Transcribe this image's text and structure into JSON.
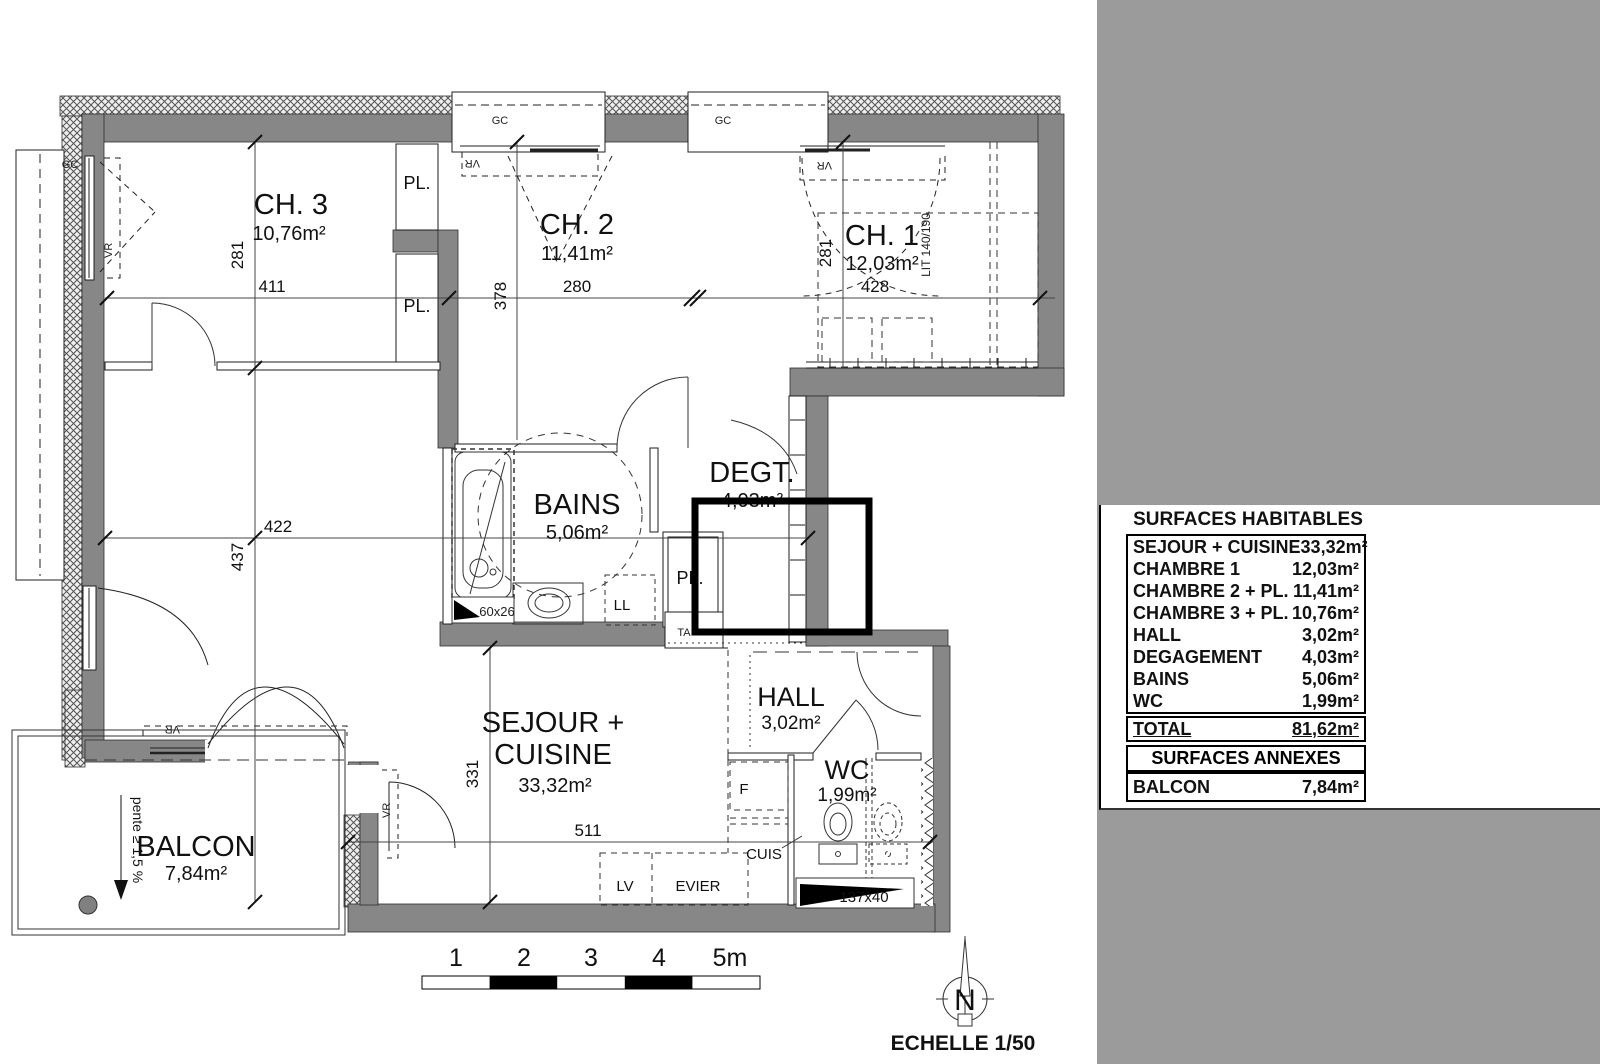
{
  "plan": {
    "rooms": {
      "ch3": {
        "name": "CH. 3",
        "area": "10,76m²"
      },
      "ch2": {
        "name": "CH. 2",
        "area": "11,41m²"
      },
      "ch1": {
        "name": "CH. 1",
        "area": "12,03m²"
      },
      "bains": {
        "name": "BAINS",
        "area": "5,06m²"
      },
      "degt": {
        "name": "DEGT.",
        "area": "4,03m²"
      },
      "hall": {
        "name": "HALL",
        "area": "3,02m²"
      },
      "wc": {
        "name": "WC",
        "area": "1,99m²"
      },
      "sejour": {
        "name_line1": "SEJOUR +",
        "name_line2": "CUISINE",
        "area": "33,32m²"
      },
      "balcon": {
        "name": "BALCON",
        "area": "7,84m²"
      }
    },
    "dimensions": {
      "ch3_h": "281",
      "ch3_w": "411",
      "ch2_h": "378",
      "ch2_w": "280",
      "ch1_h": "281",
      "ch1_w": "428",
      "left_w": "422",
      "left_h": "437",
      "sejour_h": "331",
      "sejour_w": "511"
    },
    "labels": {
      "gc": "GC",
      "vr": "VR",
      "pl": "PL.",
      "ll": "LL",
      "ta": "TA",
      "f": "F",
      "cuis": "CUIS",
      "lv": "LV",
      "evier": "EVIER",
      "lit": "LIT 140/190",
      "bath": "60x26",
      "duct": "137x40",
      "pente": "pente ≥ 1,5 %"
    }
  },
  "legend": {
    "scale_ticks": [
      "1",
      "2",
      "3",
      "4",
      "5m"
    ],
    "scale_text": "ECHELLE 1/50",
    "north": "N"
  },
  "table": {
    "title": "SURFACES HABITABLES",
    "rows": [
      {
        "label": "SEJOUR + CUISINE",
        "value": "33,32m²"
      },
      {
        "label": "CHAMBRE 1",
        "value": "12,03m²"
      },
      {
        "label": "CHAMBRE 2 + PL.",
        "value": "11,41m²"
      },
      {
        "label": "CHAMBRE 3 + PL.",
        "value": "10,76m²"
      },
      {
        "label": "HALL",
        "value": "3,02m²"
      },
      {
        "label": "DEGAGEMENT",
        "value": "4,03m²"
      },
      {
        "label": "BAINS",
        "value": "5,06m²"
      },
      {
        "label": "WC",
        "value": "1,99m²"
      }
    ],
    "total": {
      "label": "TOTAL",
      "value": "81,62m²"
    },
    "annex_title": "SURFACES ANNEXES",
    "annex": [
      {
        "label": "BALCON",
        "value": "7,84m²"
      }
    ],
    "colors": {
      "panel_gray": "#9b9b9b",
      "wall_gray": "#878787"
    }
  }
}
